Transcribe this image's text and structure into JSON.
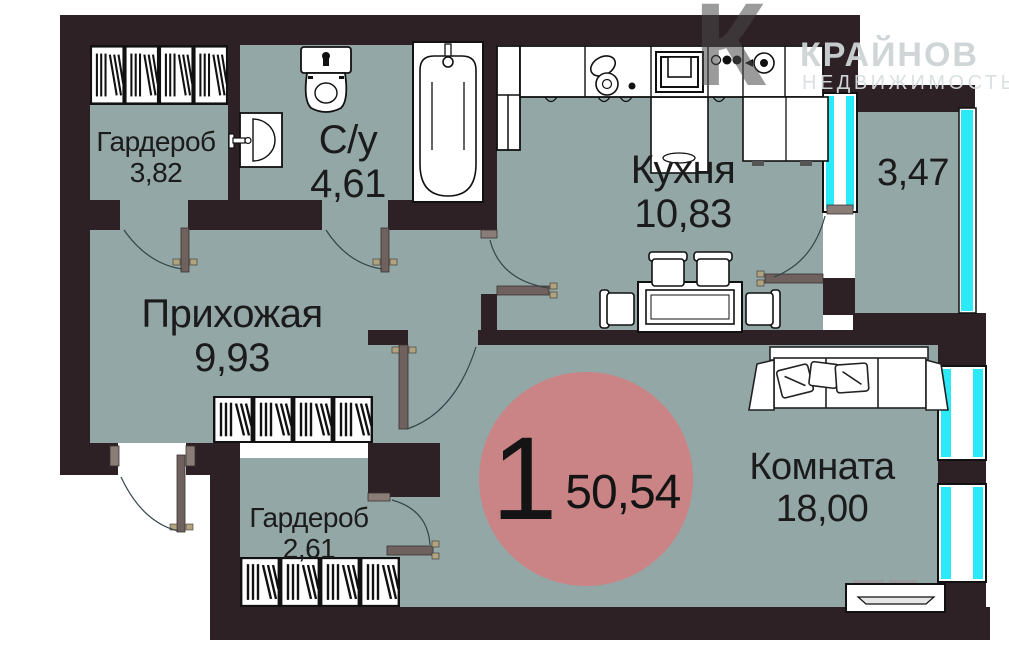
{
  "brand": {
    "logo_letter": "К",
    "name": "КРАЙНОВ",
    "tagline": "НЕДВИЖИМОСТЬ"
  },
  "plan": {
    "unit_badge": {
      "rooms_count": "1",
      "total_area": "50,54"
    },
    "rooms": [
      {
        "id": "wardrobe-top",
        "label": "Гардероб",
        "area": "3,82"
      },
      {
        "id": "bathroom",
        "label": "С/у",
        "area": "4,61"
      },
      {
        "id": "kitchen",
        "label": "Кухня",
        "area": "10,83"
      },
      {
        "id": "balcony",
        "label": "",
        "area": "3,47"
      },
      {
        "id": "hallway",
        "label": "Прихожая",
        "area": "9,93"
      },
      {
        "id": "wardrobe-bottom",
        "label": "Гардероб",
        "area": "2,61"
      },
      {
        "id": "living-room",
        "label": "Комната",
        "area": "18,00"
      }
    ],
    "colors": {
      "wall": "#2d2126",
      "floor": "#93a7a6",
      "glass": "#2be9f6",
      "badge": "#ca8486",
      "door_leaf": "#6e615e"
    }
  }
}
